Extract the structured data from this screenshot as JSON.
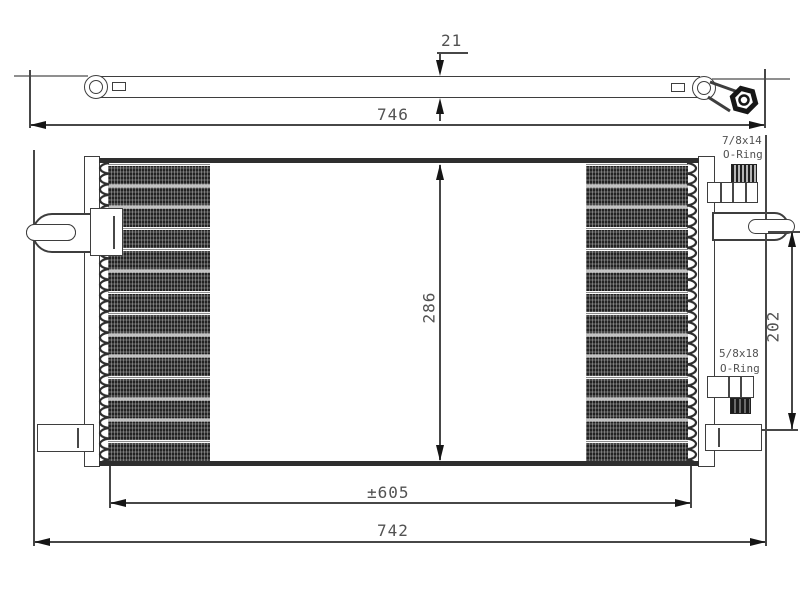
{
  "drawing": {
    "type": "technical-drawing-condenser",
    "dims": {
      "side_thickness": "21",
      "side_length": "746",
      "core_height": "286",
      "connector_span": "202",
      "core_width": "±605",
      "overall_width": "742"
    },
    "fittings": {
      "upper": {
        "thread": "7/8x14",
        "seal": "O-Ring"
      },
      "lower": {
        "thread": "5/8x18",
        "seal": "O-Ring"
      }
    },
    "colors": {
      "outline": "#3e3e3e",
      "dimension_line": "#474747",
      "fin_dark": "#2e2e2e",
      "text": "#525252",
      "background": "#ffffff"
    }
  }
}
